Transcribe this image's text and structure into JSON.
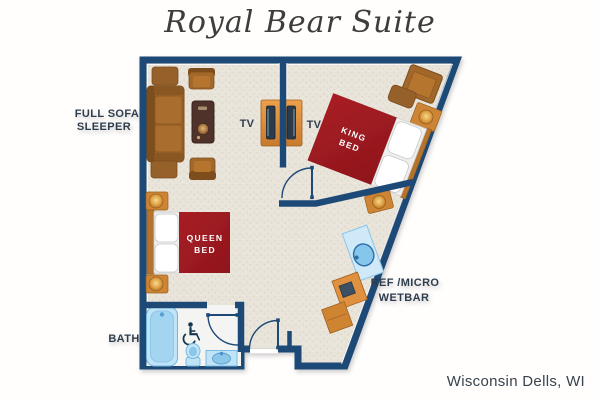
{
  "title": "Royal Bear Suite",
  "location": "Wisconsin Dells, WI",
  "labels": {
    "sofa_line1": "FULL SOFA",
    "sofa_line2": "SLEEPER",
    "tv_left": "TV",
    "tv_right": "TV",
    "king_line1": "KING",
    "king_line2": "BED",
    "queen_line1": "QUEEN",
    "queen_line2": "BED",
    "wetbar_line1": "REF /MICRO",
    "wetbar_line2": "WETBAR",
    "bath": "BATH"
  },
  "icons": {
    "wheelchair": "wheelchair-accessible-icon"
  },
  "colors": {
    "wall_navy": "#1e4976",
    "floor_beige": "#e9e4da",
    "bed_red": "#9e1b22",
    "wood_brown": "#a2672a",
    "cabinet_orange": "#cd8434",
    "fixture_blue": "#bfe3f7",
    "label_text": "#2f3e4e",
    "title_text": "#3d3d3d"
  }
}
